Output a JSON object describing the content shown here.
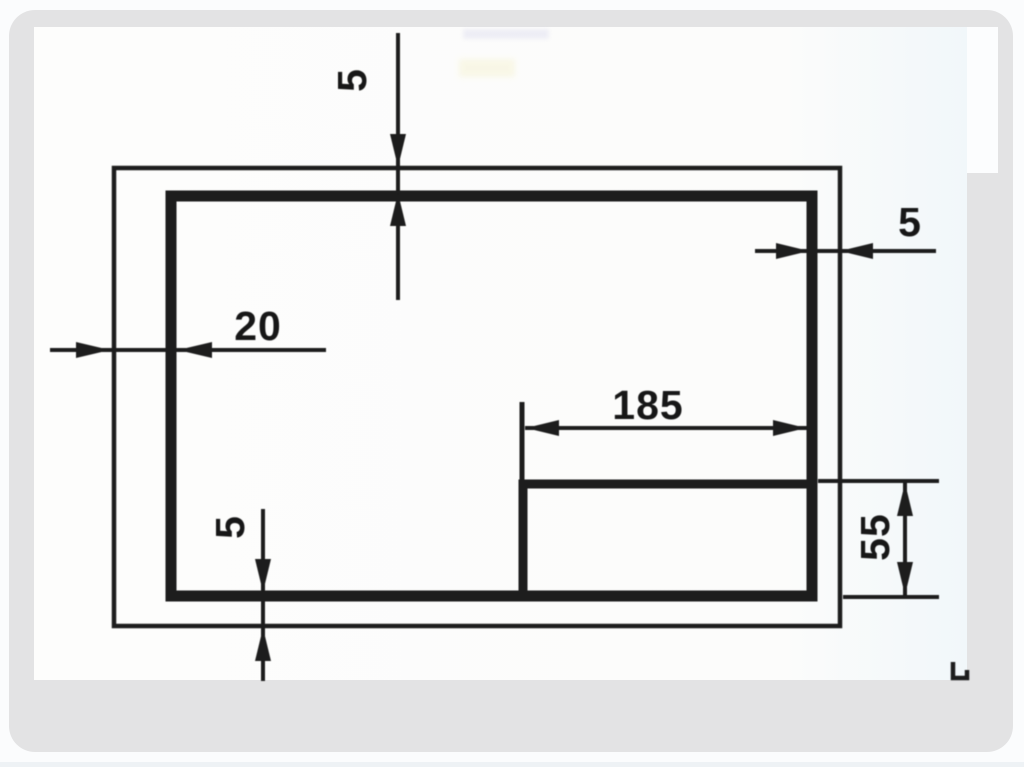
{
  "page": {
    "background": "#fbfcfd",
    "panel_color": "#e3e3e4",
    "slide_color": "#fdfdfc",
    "line_color": "#1d1d1d"
  },
  "drawing": {
    "labels": {
      "top_margin": "5",
      "right_margin": "5",
      "left_margin": "20",
      "bottom_margin": "5",
      "title_block_width": "185",
      "title_block_height": "55"
    }
  }
}
